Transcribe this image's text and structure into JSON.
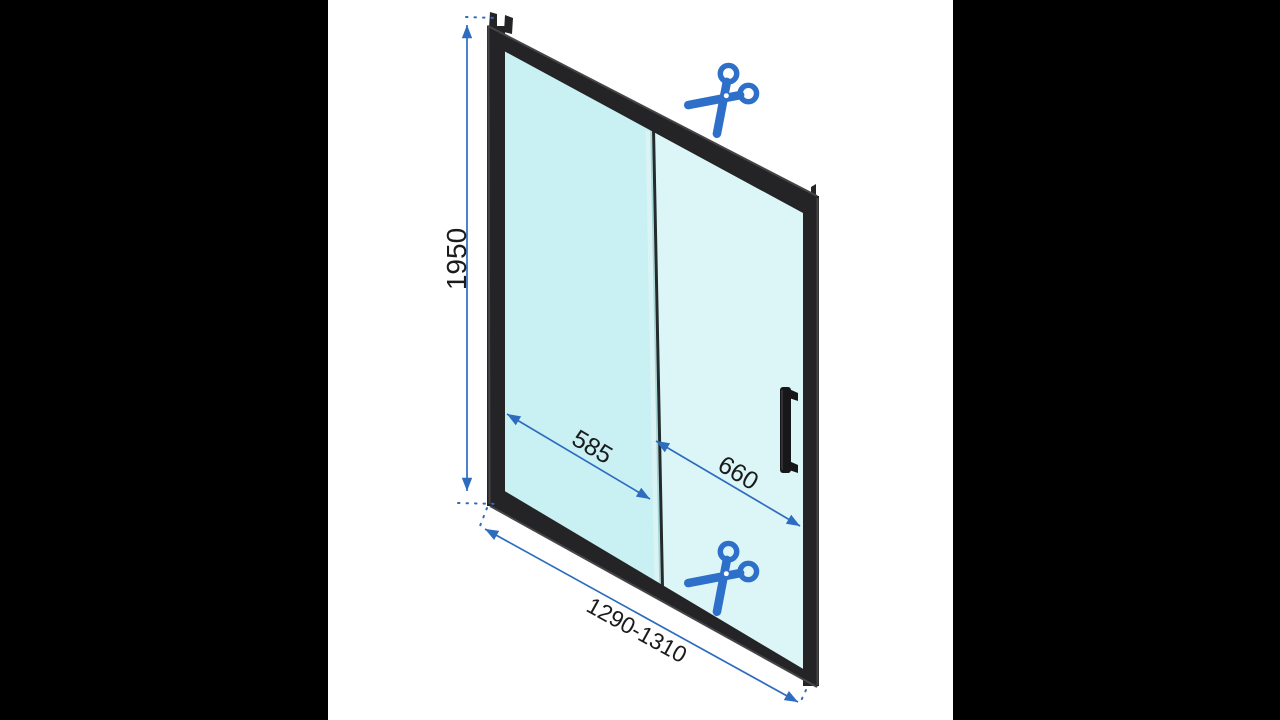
{
  "product_diagram": {
    "dimensions": {
      "height": "1950",
      "fixed_panel_width": "585",
      "door_panel_width": "660",
      "total_width_range": "1290-1310"
    },
    "icons": {
      "top": "scissors-icon",
      "bottom": "scissors-icon"
    },
    "colors": {
      "dimension_blue": "#2e6cc0",
      "scissors_blue": "#2d6fc9",
      "frame_black": "#242426",
      "glass_fixed_panel": "#c9f0f3",
      "glass_sliding_panel": "#dcf6f8",
      "letterbox": "#000000",
      "background": "#ffffff",
      "label_text": "#1b1b1b"
    }
  }
}
